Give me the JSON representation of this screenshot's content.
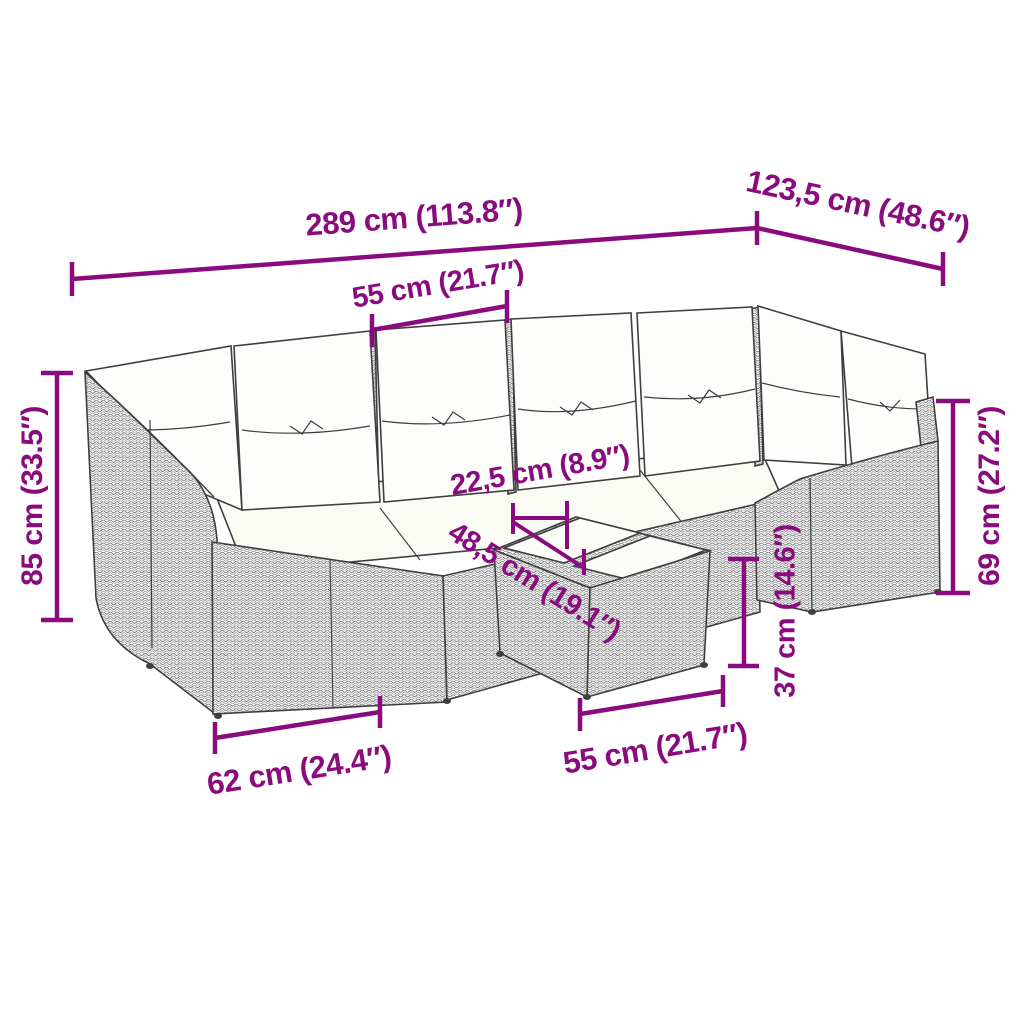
{
  "diagram": {
    "type": "product-dimension-drawing",
    "subject": "poly-rattan corner garden sofa set with back and seat cushions and a footstool table with two tray tops",
    "dimension_labels": {
      "overall_width": "289 cm (113.8″)",
      "overall_depth": "123,5 cm (48.6″)",
      "seat_width": "55 cm (21.7″)",
      "total_height": "85 cm (33.5″)",
      "back_height": "69 cm (27.2″)",
      "tray_width": "22,5 cm (8.9″)",
      "tray_length": "48,5 cm (19.1″)",
      "ottoman_height": "37 cm (14.6″)",
      "seat_depth": "62 cm (24.4″)",
      "ottoman_width": "55 cm (21.7″)"
    }
  },
  "colors": {
    "dimension_accent": "#8A0B7D",
    "line_art": "#3F3F3F",
    "rattan_gray": "#7A7A7A",
    "cushion_white": "#FDFDFB",
    "background": "#FFFFFF"
  }
}
